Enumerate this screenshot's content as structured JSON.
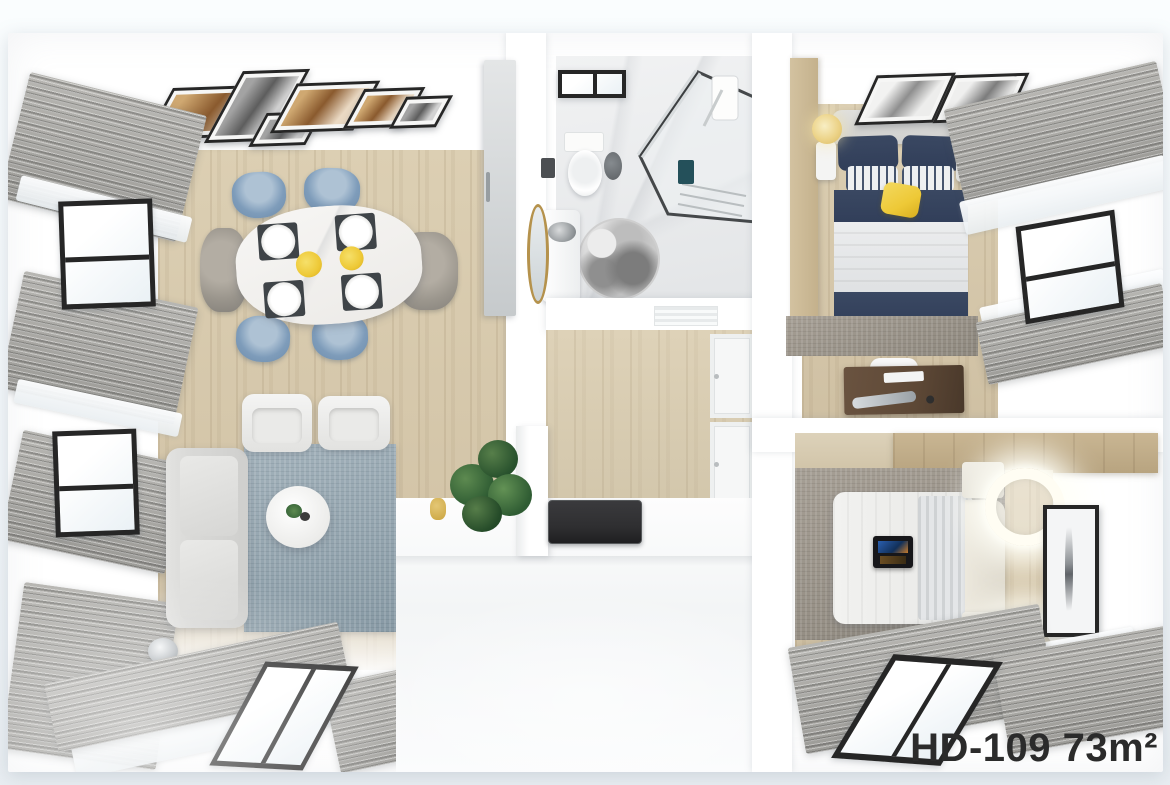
{
  "label": {
    "text": "HD-109 73m²",
    "model": "HD-109",
    "area": "73m²"
  },
  "colors": {
    "bg-top": "#fafdfe",
    "bg": "#f2f6f9",
    "wall": "#ffffff",
    "wood": "#cfc0a3",
    "wood-hi": "#dccfb3",
    "curtain": "#9c9b97",
    "curtain-hi": "#b7b6b2",
    "frame": "#262626",
    "navy": "#313e59",
    "chair-blue": "#7e9cba",
    "chair-gray": "#9b968d",
    "rug-blue": "#93a5af",
    "rug-gray": "#9a948a",
    "sofa": "#d9d9d7",
    "yellow": "#eec937",
    "lamp": "#ecd388",
    "plant": "#2f5c33",
    "desk": "#5d4836",
    "gold": "#b5924c",
    "cooktop": "#2f2f31",
    "label": "#2b2b2b"
  },
  "scene": {
    "type": "apartment-floorplan-3d-top-view",
    "rooms": [
      {
        "id": "living-dining",
        "items": [
          "wall-art-frames",
          "curtained-windows",
          "marble-dining-table",
          "dining-chairs-blue",
          "dining-chairs-gray",
          "plates",
          "yellow-centerpieces",
          "sofa",
          "armchairs",
          "blue-area-rug",
          "round-coffee-table",
          "floor-lamp",
          "bathroom-door"
        ]
      },
      {
        "id": "bathroom",
        "items": [
          "toilet",
          "glass-shower",
          "vanity-sink",
          "gold-round-mirror",
          "marble-floor-medallion",
          "window"
        ]
      },
      {
        "id": "kitchen",
        "items": [
          "cooktop",
          "island-counter",
          "cabinet-doors",
          "potted-plant",
          "ceiling-vent"
        ]
      },
      {
        "id": "hallway",
        "items": []
      },
      {
        "id": "bedroom-master",
        "items": [
          "navy-striped-double-bed",
          "yellow-throw",
          "table-lamps-yellow",
          "nightstands",
          "wall-art-frames",
          "wardrobe",
          "gray-rug",
          "dressing-desk",
          "curtained-window"
        ]
      },
      {
        "id": "bedroom-second",
        "items": [
          "light-double-bed",
          "laptop-on-bed",
          "glowing-ring-lamps",
          "nightstands",
          "wall-art",
          "wardrobe-band",
          "gray-rug",
          "curtained-window"
        ]
      }
    ]
  }
}
